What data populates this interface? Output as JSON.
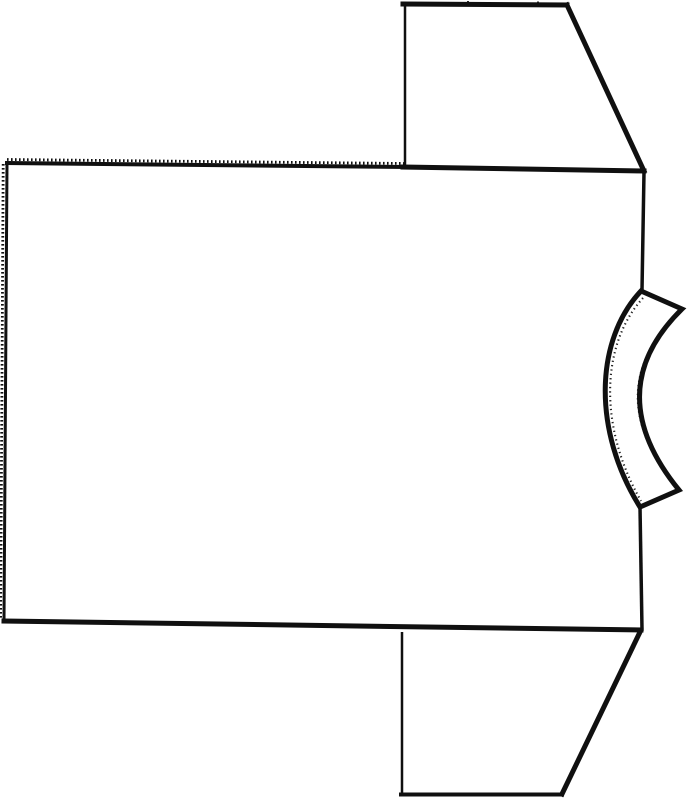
{
  "colors": {
    "ink": "#101010",
    "paper": "#ffffff"
  },
  "drawing": {
    "kind": "t-shirt sewing-pattern line drawing, rotated 90° (collar at right)",
    "viewbox": "0 0 687 800",
    "shapes": {
      "body_top_serrated": {
        "d": "M 7 163 L 406 167"
      },
      "body_top_teeth": {
        "d": "M 7 159.5 L 406 163.5"
      },
      "body_left_edge": {
        "d": "M 7 163 L 4 621"
      },
      "body_left_teeth": {
        "d": "M 3.2 164 L 0.6 620"
      },
      "body_bottom_edge": {
        "d": "M 4 621 L 641 630"
      },
      "body_right_upper": {
        "d": "M 644 172 L 642 290"
      },
      "body_right_lower": {
        "d": "M 640 507 L 642 629"
      },
      "sleeve_top_left": {
        "d": "M 405 6 L 405 165"
      },
      "sleeve_top_top": {
        "d": "M 403 4 L 567 5"
      },
      "sleeve_top_notches": {
        "d": "M 468 1 L 468 6 M 538 1.5 L 538 6.5"
      },
      "sleeve_top_diag": {
        "d": "M 567 5 L 644 171"
      },
      "sleeve_top_bottom": {
        "d": "M 403 167 L 644 171"
      },
      "neckband_outline": {
        "d": "M 641 291 C 595 340 592 430 640 507 L 679 490 C 622 420 630 360 682 309 Z"
      },
      "neckband_inner_rough": {
        "d": "M 643 298 C 601 344 598 426 641 501"
      },
      "neckband_outer_rough": {
        "d": "M 678 313 C 629 362 621 418 675 485"
      },
      "sleeve_bottom_left": {
        "d": "M 402 632 L 402 793"
      },
      "sleeve_bottom_bottom": {
        "d": "M 401 794.5 L 562 794.5"
      },
      "sleeve_bottom_diag": {
        "d": "M 640 632 L 562 794"
      }
    }
  }
}
